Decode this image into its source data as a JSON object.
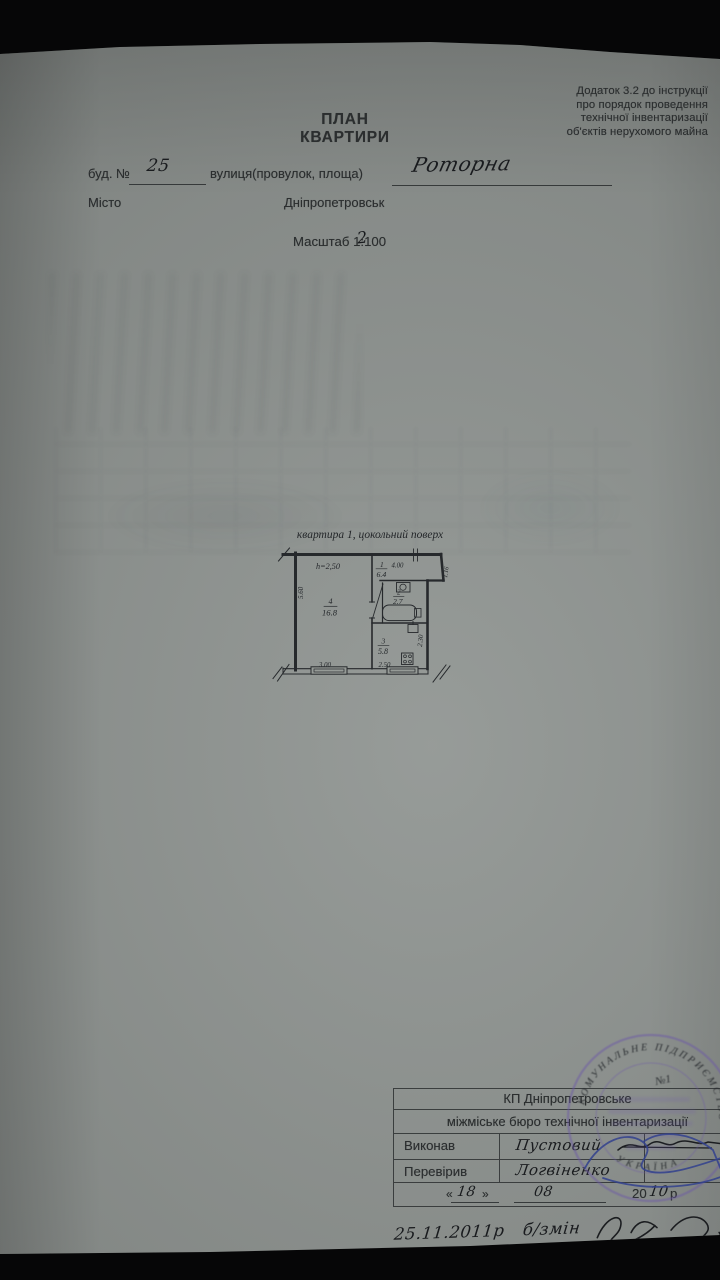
{
  "document": {
    "regulation_note": [
      "Додаток 3.2 до інструкції",
      "про порядок проведення",
      "технічної інвентаризації",
      "об'єктів нерухомого майна"
    ],
    "title": {
      "line1": "ПЛАН",
      "line2": "КВАРТИРИ"
    },
    "address": {
      "building_label": "буд. №",
      "building_number": "25",
      "street_label": "вулиця(провулок, площа)",
      "street_name": "Роторна",
      "city_label": "Місто",
      "city_name": "Дніпропетровськ"
    },
    "scale": {
      "label": "Масштаб 1:",
      "printed_value": "100",
      "handwritten_correction": "2"
    },
    "plan": {
      "caption": "квартира 1,  цокольний поверх",
      "ceiling_height": "h=2,50",
      "rooms": [
        {
          "num": "4",
          "area": "16.8"
        },
        {
          "num": "1",
          "area": "6.4"
        },
        {
          "num": "2",
          "area": "2.7"
        },
        {
          "num": "3",
          "area": "5.8"
        }
      ],
      "dims": {
        "left": "5.60",
        "top": "4.00",
        "right_top": "1.16",
        "right_mid": "2.30",
        "bottom_left": "3.00",
        "bottom_right": "2.50"
      }
    },
    "footer": {
      "org_line1": "КП Дніпропетровське",
      "org_line2": "міжміське бюро технічної інвентаризації",
      "executed_label": "Виконав",
      "executed_by": "Пустовий",
      "checked_label": "Перевірив",
      "checked_by": "Логвіненко",
      "date": {
        "open_quote": "«",
        "day": "18",
        "close_quote": "»",
        "month": "08",
        "year_printed": "20",
        "year_handwritten": "10",
        "year_suffix": "р"
      },
      "handwritten_note": {
        "date": "25.11.2011р",
        "text": "б/змін"
      }
    },
    "stamp": {
      "arc_top": "КОМУНАЛЬНЕ ПІДПРИЄМСТВО",
      "arc_bottom": "УКРАЇНА",
      "number": "№1"
    }
  }
}
